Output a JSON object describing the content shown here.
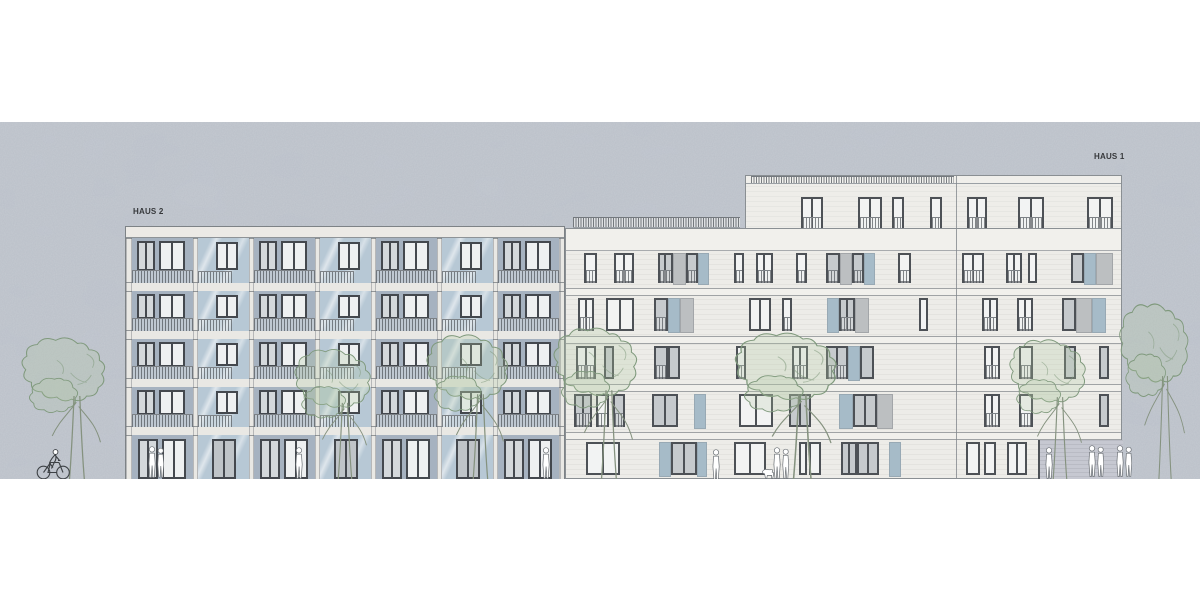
{
  "scene": {
    "top": 122,
    "height": 357,
    "width": 1200,
    "sky_color": "#c6cbd2"
  },
  "haus2": {
    "label": "HAUS 2",
    "label_pos": {
      "x": 133,
      "y": 207
    },
    "left": 125,
    "top": 226,
    "width": 440,
    "height": 253,
    "parapet_h": 11,
    "bays": [
      {
        "x": 6,
        "w": 61,
        "t": "A"
      },
      {
        "x": 72,
        "w": 51,
        "t": "B"
      },
      {
        "x": 128,
        "w": 61,
        "t": "A"
      },
      {
        "x": 194,
        "w": 51,
        "t": "B"
      },
      {
        "x": 250,
        "w": 61,
        "t": "A"
      },
      {
        "x": 316,
        "w": 51,
        "t": "B"
      },
      {
        "x": 372,
        "w": 61,
        "t": "A"
      }
    ],
    "rows": [
      {
        "y": 0,
        "h": 45,
        "ground": false
      },
      {
        "y": 53,
        "h": 40,
        "ground": false
      },
      {
        "y": 101,
        "h": 40,
        "ground": false
      },
      {
        "y": 149,
        "h": 40,
        "ground": false
      },
      {
        "y": 197,
        "h": 45,
        "ground": true
      }
    ],
    "colors": {
      "panel": "#a6b2c0",
      "glaze": "#b7c8d5",
      "band": "#e9e8e4",
      "frame": "#44484e",
      "pane_light": "#d4d8db",
      "pane_white": "#eef0f1",
      "pane_gray": "#bfc4c8"
    }
  },
  "haus1": {
    "label": "HAUS 1",
    "label_pos": {
      "x": 1094,
      "y": 152
    },
    "left": 565,
    "top": 228,
    "width": 557,
    "height": 251,
    "joint_x": 390,
    "top_band_h": 22,
    "rows": [
      {
        "y": 22,
        "h": 37,
        "units": [
          [
            18,
            13,
            "wr"
          ],
          [
            48,
            20,
            "wr"
          ],
          [
            92,
            15,
            "gr"
          ],
          [
            107,
            13,
            "p"
          ],
          [
            120,
            12,
            "gr"
          ],
          [
            132,
            11,
            "b"
          ],
          [
            168,
            10,
            "wr"
          ],
          [
            190,
            17,
            "wr"
          ],
          [
            230,
            11,
            "wr"
          ],
          [
            260,
            14,
            "gr"
          ],
          [
            274,
            12,
            "p"
          ],
          [
            286,
            12,
            "gr"
          ],
          [
            298,
            11,
            "b"
          ],
          [
            332,
            13,
            "wr"
          ],
          [
            396,
            22,
            "wr"
          ],
          [
            440,
            16,
            "wr"
          ],
          [
            462,
            9,
            "w"
          ],
          [
            505,
            13,
            "g"
          ],
          [
            518,
            12,
            "b"
          ],
          [
            530,
            17,
            "p"
          ]
        ]
      },
      {
        "y": 67,
        "h": 40,
        "units": [
          [
            12,
            16,
            "wr"
          ],
          [
            40,
            28,
            "w"
          ],
          [
            88,
            14,
            "gr"
          ],
          [
            102,
            12,
            "b"
          ],
          [
            114,
            14,
            "p"
          ],
          [
            183,
            22,
            "w"
          ],
          [
            216,
            10,
            "wr"
          ],
          [
            261,
            12,
            "b"
          ],
          [
            273,
            16,
            "gr"
          ],
          [
            289,
            14,
            "p"
          ],
          [
            353,
            9,
            "w"
          ],
          [
            416,
            16,
            "wr"
          ],
          [
            451,
            16,
            "wr"
          ],
          [
            496,
            14,
            "g"
          ],
          [
            510,
            16,
            "p"
          ],
          [
            526,
            14,
            "b"
          ]
        ]
      },
      {
        "y": 115,
        "h": 40,
        "units": [
          [
            10,
            20,
            "wr"
          ],
          [
            38,
            10,
            "g"
          ],
          [
            88,
            14,
            "gr"
          ],
          [
            102,
            12,
            "g"
          ],
          [
            170,
            10,
            "wr"
          ],
          [
            226,
            16,
            "wr"
          ],
          [
            260,
            22,
            "gr"
          ],
          [
            282,
            12,
            "b"
          ],
          [
            294,
            14,
            "g"
          ],
          [
            418,
            16,
            "wr"
          ],
          [
            453,
            14,
            "wr"
          ],
          [
            498,
            12,
            "g"
          ],
          [
            533,
            10,
            "g"
          ]
        ]
      },
      {
        "y": 163,
        "h": 40,
        "units": [
          [
            8,
            18,
            "gr"
          ],
          [
            30,
            13,
            "wr"
          ],
          [
            47,
            12,
            "gr"
          ],
          [
            86,
            26,
            "g"
          ],
          [
            128,
            12,
            "b"
          ],
          [
            173,
            34,
            "w"
          ],
          [
            223,
            22,
            "g"
          ],
          [
            273,
            14,
            "b"
          ],
          [
            287,
            24,
            "g"
          ],
          [
            311,
            16,
            "p"
          ],
          [
            418,
            16,
            "wr"
          ],
          [
            453,
            14,
            "wr"
          ],
          [
            533,
            10,
            "g"
          ]
        ]
      },
      {
        "y": 211,
        "h": 40,
        "units": [
          [
            20,
            34,
            "w"
          ],
          [
            93,
            12,
            "b"
          ],
          [
            105,
            26,
            "g"
          ],
          [
            131,
            10,
            "b"
          ],
          [
            168,
            32,
            "w"
          ],
          [
            233,
            8,
            "w"
          ],
          [
            243,
            12,
            "w"
          ],
          [
            275,
            16,
            "g"
          ],
          [
            291,
            22,
            "g"
          ],
          [
            323,
            12,
            "b"
          ],
          [
            400,
            14,
            "w"
          ],
          [
            418,
            12,
            "w"
          ],
          [
            441,
            20,
            "w"
          ]
        ]
      }
    ],
    "recess": {
      "x": 472,
      "w": 85,
      "y": 211,
      "h": 40,
      "color": "#c6c8d1"
    },
    "penthouse": {
      "left": 745,
      "top": 175,
      "width": 377,
      "height": 75,
      "parapet_h": 8,
      "rail_x": 5,
      "rail_w": 203,
      "joint_x": 210,
      "win_y": 21,
      "win_h": 36,
      "units": [
        [
          55,
          22
        ],
        [
          112,
          24
        ],
        [
          146,
          12
        ],
        [
          184,
          12
        ],
        [
          221,
          20
        ],
        [
          272,
          26
        ],
        [
          341,
          26
        ]
      ]
    },
    "terrace_rail": {
      "left": 573,
      "top": 217,
      "width": 167,
      "height": 11
    },
    "colors": {
      "wall": "#edece8",
      "band": "#f1f0ec",
      "frame": "#4d5156",
      "pane_white": "#f2f3f3",
      "pane_gray": "#c6cacd",
      "panel": "#bcbfc1",
      "blue": "#a6bbc8"
    }
  },
  "trees": [
    {
      "x": 20,
      "y": 333,
      "w": 115,
      "h": 147
    },
    {
      "x": 293,
      "y": 345,
      "w": 105,
      "h": 135
    },
    {
      "x": 425,
      "y": 330,
      "w": 112,
      "h": 150
    },
    {
      "x": 552,
      "y": 323,
      "w": 115,
      "h": 157
    },
    {
      "x": 733,
      "y": 328,
      "w": 140,
      "h": 155
    },
    {
      "x": 1008,
      "y": 335,
      "w": 105,
      "h": 145
    },
    {
      "x": 1118,
      "y": 298,
      "w": 95,
      "h": 182
    }
  ],
  "people": [
    {
      "x": 146,
      "y": 446,
      "type": "duo"
    },
    {
      "x": 293,
      "y": 447,
      "type": "solo"
    },
    {
      "x": 540,
      "y": 447,
      "type": "solo"
    },
    {
      "x": 710,
      "y": 449,
      "type": "solo"
    },
    {
      "x": 762,
      "y": 447,
      "type": "duo-dog"
    },
    {
      "x": 1043,
      "y": 447,
      "type": "solo"
    },
    {
      "x": 1086,
      "y": 445,
      "type": "duo"
    },
    {
      "x": 1114,
      "y": 445,
      "type": "duo"
    }
  ],
  "cyclist": {
    "x": 36,
    "y": 447,
    "w": 34,
    "h": 33
  }
}
